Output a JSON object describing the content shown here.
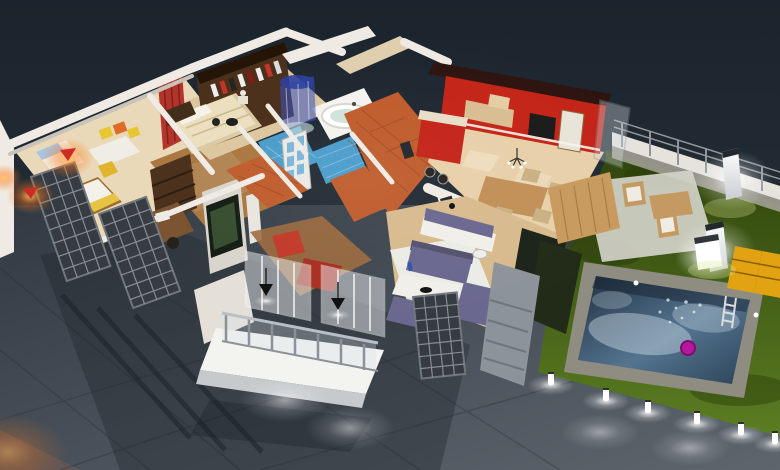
{
  "scene": {
    "title": "Night-time 3D isometric floor plan render of a villa",
    "style": "photorealistic architectural visualization, cutaway walls, no text or UI chrome",
    "rooms": [
      {
        "name": "kids-bedroom",
        "items": [
          "single-bed-blue",
          "single-bed-yellow",
          "white-desk",
          "yellow-chair",
          "colored-wall-frames",
          "red-wall-lamps"
        ]
      },
      {
        "name": "study",
        "items": [
          "dark-bookshelf",
          "wood-desk",
          "office-chair",
          "tv-partition"
        ]
      },
      {
        "name": "master-bedroom",
        "items": [
          "cream-double-bed",
          "dark-headboard",
          "walk-in-closet-with-clothes",
          "red-curtain",
          "nightstand-lamp"
        ]
      },
      {
        "name": "bathroom",
        "items": [
          "round-blue-shower",
          "round-white-tub",
          "blue-mosaic-floor",
          "glazed-doors"
        ]
      },
      {
        "name": "kitchen",
        "items": [
          "glossy-red-cabinets",
          "wood-upper-cabinets",
          "black-oven",
          "red-island",
          "bar-stools"
        ]
      },
      {
        "name": "dining-area",
        "items": [
          "wood-table",
          "wicker-chairs",
          "chandelier",
          "framed-pictures"
        ]
      },
      {
        "name": "living-room",
        "items": [
          "purple-sofa",
          "purple-chaise",
          "purple-lounger",
          "purple-cushion-bench",
          "white-coffee-table",
          "light-rug",
          "dark-tv-wall",
          "stone-column"
        ]
      },
      {
        "name": "balcony",
        "items": [
          "white-deck",
          "glass-railing",
          "glass-partitions",
          "black-pendant-lamps",
          "red-armchair",
          "red-sofa"
        ]
      }
    ],
    "exterior": [
      "reflective-dark-ground",
      "lattice-metal-screens",
      "lawn",
      "swimming-pool",
      "pool-ladder",
      "pink-pool-float",
      "perimeter-fence-with-railing",
      "garden-table-and-chairs",
      "glowing-pillar-lamps",
      "glowing-cube-lamp",
      "yellow-sun-loungers",
      "bollard-path-lights",
      "warm-corner-glow"
    ]
  },
  "palette": {
    "wall_white": "#efebe4",
    "wall_shade": "#c9c3b9",
    "wall_beige": "#e0cfae",
    "roof_dark": "#2e1410",
    "kitchen_red": "#c42418",
    "cabinet_wood": "#d9bd93",
    "appliance_black": "#1b1b1b",
    "cabinet_white": "#e9e4da",
    "floor_kitchen": "#e8d0a9",
    "floor_tan": "#d8ba8e",
    "floor_kids": "#ead9b8",
    "floor_master": "#dcc69e",
    "floor_wood": "#a9763f",
    "floor_terracotta": "#bf5c2c",
    "rug_white": "#eef0ee",
    "bath_tile": "#4a9ccb",
    "shower_glass": "#3550c0",
    "tub_white": "#f4f3ef",
    "tub_water": "#cfe3da",
    "door_white": "#e9eae5",
    "door_pane": "#7db5d8",
    "bed_cream": "#ecdfbe",
    "headboard_brown": "#402d19",
    "bed_yellow": "#e5c443",
    "chair_yellow": "#e0b42c",
    "desk_white": "#f0ede6",
    "frame_yellow": "#e8c532",
    "frame_orange": "#dd6a28",
    "wood_dark": "#4a2f1a",
    "wood_mid": "#7a5230",
    "curtain_red": "#b2332a",
    "armchair_red": "#c13a2a",
    "tv_dark": "#1c241a",
    "sofa_purple": "#6b6890",
    "sofa_purple_dark": "#55526e",
    "table_white": "#f1efe9",
    "deck_white": "#f3f3f0",
    "deck_edge": "#c6cacd",
    "glass_pane": "#d8e2e8",
    "metal_gray": "#8a9198",
    "lattice_dark": "#363b41",
    "lattice_line": "#9aa1a8",
    "stone_gray": "#8d939a",
    "hedge_dark": "#222b18",
    "fence_white": "#e6e3dc",
    "pool_coping": "#8f8c82",
    "pool_foam": "#dce9f0",
    "float_pink": "#b5179e",
    "lounger_yellow": "#e2a312",
    "patio_concrete": "#d3d3c9",
    "patio_wood": "#c49a62"
  }
}
